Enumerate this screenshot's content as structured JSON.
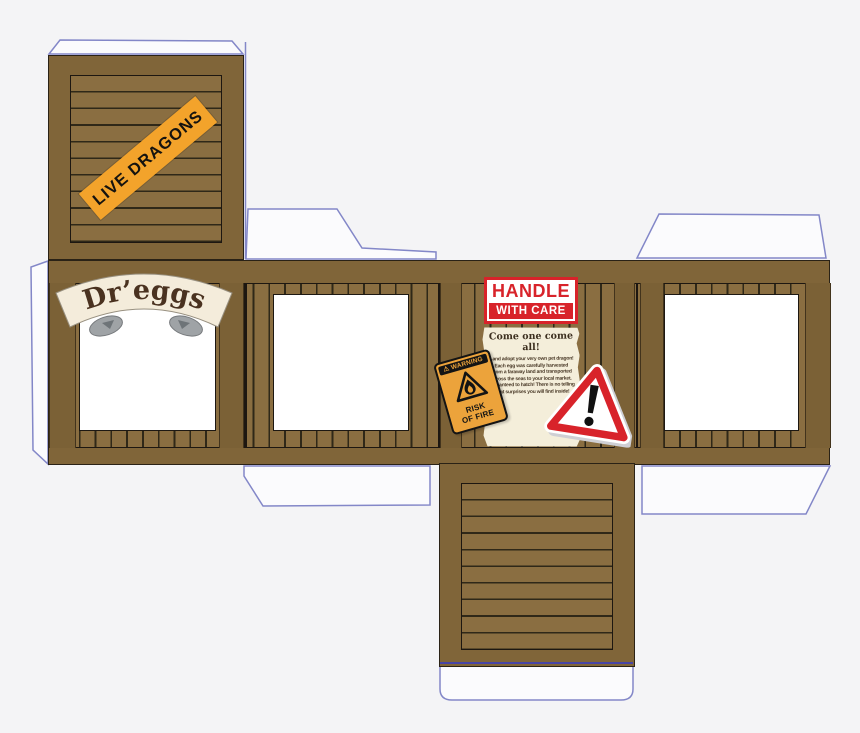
{
  "template": {
    "name": "dragon-egg-crate-papercraft",
    "colors": {
      "plank": "#8a6e41",
      "rail": "#806539",
      "stile": "#7b6136",
      "flap_outline": "#8387c8",
      "sticker_orange": "#f3a32b",
      "sign_red": "#d8232a",
      "warning_orange": "#eca33b",
      "parchment": "#f4eeda",
      "fold_line_blue": "#4744a5"
    }
  },
  "stickers": {
    "live_dragons": "LIVE DRAGONS",
    "scroll_title": "Dr’eggs",
    "handle_sign": {
      "line1": "HANDLE",
      "line2": "WITH CARE"
    },
    "poster": {
      "title": "Come one come all!",
      "lines": [
        "...and adopt your very own pet dragon!",
        "Each egg was carefully harvested",
        "From a faraway land and transported",
        "across the seas to your local market.",
        "Guaranteed to hatch! There is no telling",
        "what surprises you will find inside!"
      ]
    },
    "warning_sign": {
      "header": "⚠ WARNING",
      "lines": [
        "RISK",
        "OF FIRE"
      ]
    },
    "hazard_triangle": {
      "symbol": "!"
    }
  }
}
